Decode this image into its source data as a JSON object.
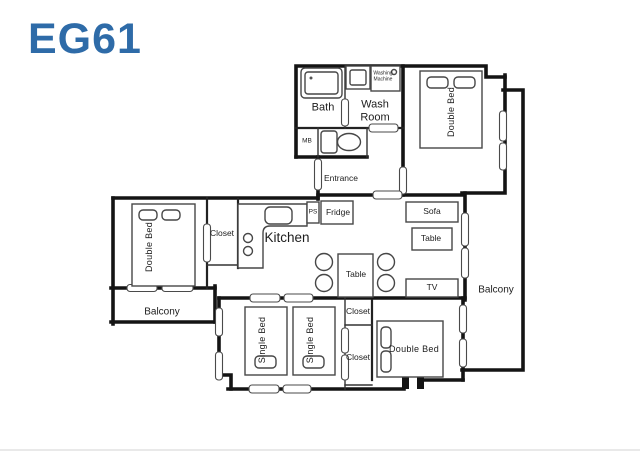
{
  "title": "EG61",
  "colors": {
    "accent": "#2e6ba8",
    "wall": "#141414",
    "furniture": "#474747"
  },
  "plan": {
    "bath": "Bath",
    "wash_room": "Wash Room",
    "washing_machine": "Washing Machine",
    "mb": "MB",
    "entrance": "Entrance",
    "bedroom_top_right": "Double Bed",
    "hall_closet": "Closet",
    "kitchen": "Kitchen",
    "ps": "PS",
    "fridge": "Fridge",
    "sofa": "Sofa",
    "sofa_table": "Table",
    "dining_table": "Table",
    "tv": "TV",
    "bedroom_left": "Double Bed",
    "balcony_left": "Balcony",
    "single_bed_1": "Single Bed",
    "single_bed_2": "Single Bed",
    "closet_upper": "Closet",
    "closet_lower": "Closet",
    "bedroom_bottom_right": "Double Bed",
    "balcony_right": "Balcony"
  }
}
